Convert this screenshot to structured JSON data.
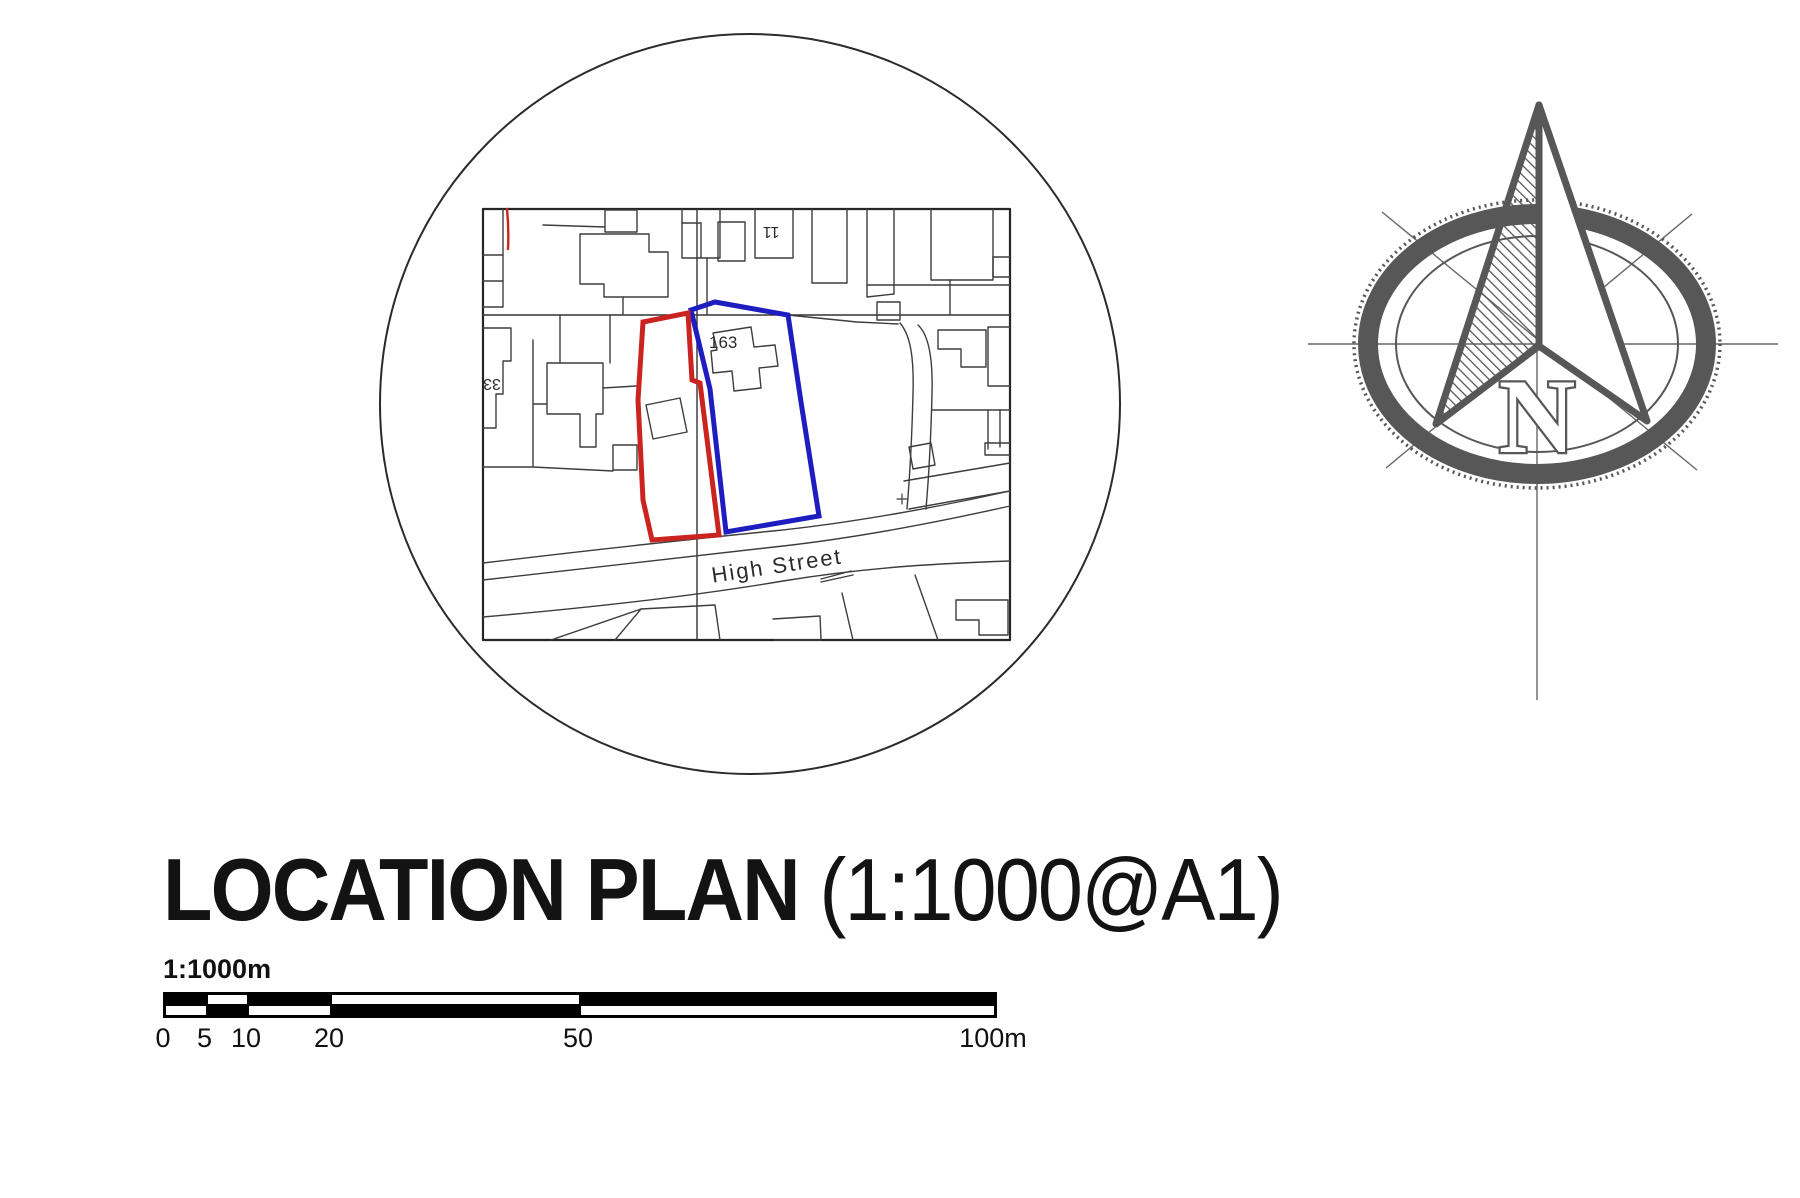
{
  "title": {
    "main": "LOCATION PLAN",
    "suffix": " (1:1000@A1)"
  },
  "map": {
    "labels": {
      "plot_number": "163",
      "street_name": "High Street",
      "house_number_left": "33",
      "house_number_top": "11"
    },
    "colors": {
      "site_outline": "#cb2420",
      "adjacent_outline": "#1d1dc0",
      "line": "#3d3d3d"
    }
  },
  "compass": {
    "letter": "N",
    "color": "#575757"
  },
  "scale_bar": {
    "ratio_label": "1:1000m",
    "ticks": [
      "0",
      "5",
      "10",
      "20",
      "50",
      "100m"
    ]
  }
}
